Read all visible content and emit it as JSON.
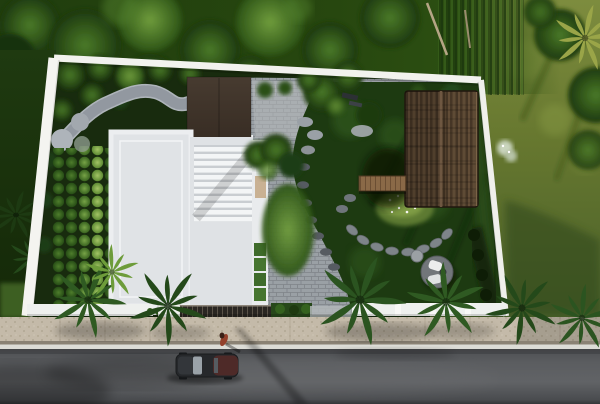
{
  "window": {
    "kind": "aerial-3d-architectural-render",
    "width": 600,
    "height": 404
  },
  "scene": {
    "outside": {
      "top": "dense tree canopy and palms",
      "right": "open olive-green lawn with tree clumps",
      "left": "dark grass strip with ferns",
      "bottom": "speckled concrete sidewalk, white curb and asphalt road"
    },
    "lot": {
      "perimeter": "white boundary wall, slightly skewed perspective",
      "house": {
        "main_roof": "white flat roof with parapet",
        "louver_section": "white slatted pergola roof",
        "carport_roof": "dark bronze flat canopy",
        "edge_planters": "four green planter boxes and timber bench",
        "garden_rows": "five columns of round clipped shrubs"
      },
      "pavilion": {
        "roof": "brown thatched roof with centre ridge",
        "deck": "timber plank walkway on left side"
      },
      "garden": {
        "pebble_path": "winding grey pebble path among broadleaf plants",
        "flower_bed": "light green bed dotted with white flowers",
        "stepping_stones": "curved fans of grey stones around bed and path edge",
        "lounge": {
          "platform": "round grey pad",
          "chairs": 2,
          "ottoman": 1
        },
        "lawn": "dark green lawn with tree shadows",
        "hedge": "dark hedge along inner right wall"
      },
      "front": {
        "gate_fence": "dark slatted fence",
        "gate_pillar": "white gate post",
        "hedge": "low green hedge",
        "driveway": "grey paver driveway opening"
      }
    },
    "street": {
      "car": "dark sedan with maroon rear, parked facing left",
      "figure": "person in red-brown beside the car on the curb",
      "shadows": "long diagonal tree shadows across sidewalk and road"
    }
  },
  "palette": {
    "forest": "#27470f",
    "grass_outside": "#6d7d35",
    "ground_dark": "#182b0e",
    "lawn": "#1d3a11",
    "paver": "#9aa0a5",
    "paver_line": "#7e8388",
    "roof_white": "#eceef0",
    "roof_panel": "#e0e3e6",
    "louver_light": "#f3f5f6",
    "louver_dark": "#c9cdd1",
    "carport_roof": "#41362c",
    "thatch": "#52402d",
    "deck_wood": "#8a6947",
    "wall_white": "#f2f2ee",
    "stone_path": "#aeb4ba",
    "hedge": "#27481a",
    "fence_dark": "#2a2622",
    "sidewalk": "#c4baa9",
    "curb": "#dcdcd6",
    "road": "#5a5c5f",
    "car_body": "#26282b",
    "car_rear": "#4e2a28",
    "figure_red": "#93402b",
    "platform": "#72767a",
    "chair_white": "#eceded",
    "flower_bed": "#5d7a32"
  }
}
